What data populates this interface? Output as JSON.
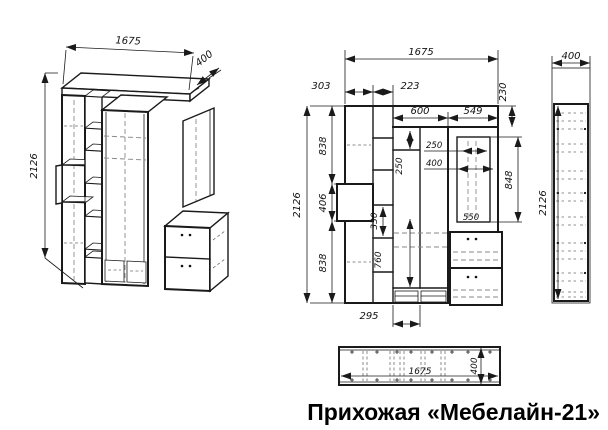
{
  "title": "Прихожая «Мебелайн-21»",
  "colors": {
    "line": "#1a1a1a",
    "hidden": "#888888",
    "text": "#111111",
    "background": "#ffffff"
  },
  "views": {
    "isometric": {
      "dims": {
        "width": "1675",
        "depth": "400",
        "height": "2126"
      }
    },
    "front": {
      "dims": {
        "overall_width": "1675",
        "col1_width": "303",
        "col2_width": "223",
        "cornice_height": "230",
        "wardrobe_width": "600",
        "mirror_section_width": "549",
        "overall_height": "2126",
        "upper_section_height": "838",
        "niche_height": "406",
        "lower_section_height": "838",
        "shelf_gap_height": "330",
        "top_shelf_height": "250",
        "mirror_width_inner": "250",
        "mirror_width": "400",
        "mirror_height": "848",
        "cabinet_width": "550",
        "shoe_shelf_width": "295",
        "lower_clearance": "760"
      }
    },
    "side": {
      "dims": {
        "depth": "400",
        "height": "2126"
      }
    },
    "plan": {
      "dims": {
        "width": "1675",
        "depth": "400"
      }
    }
  }
}
